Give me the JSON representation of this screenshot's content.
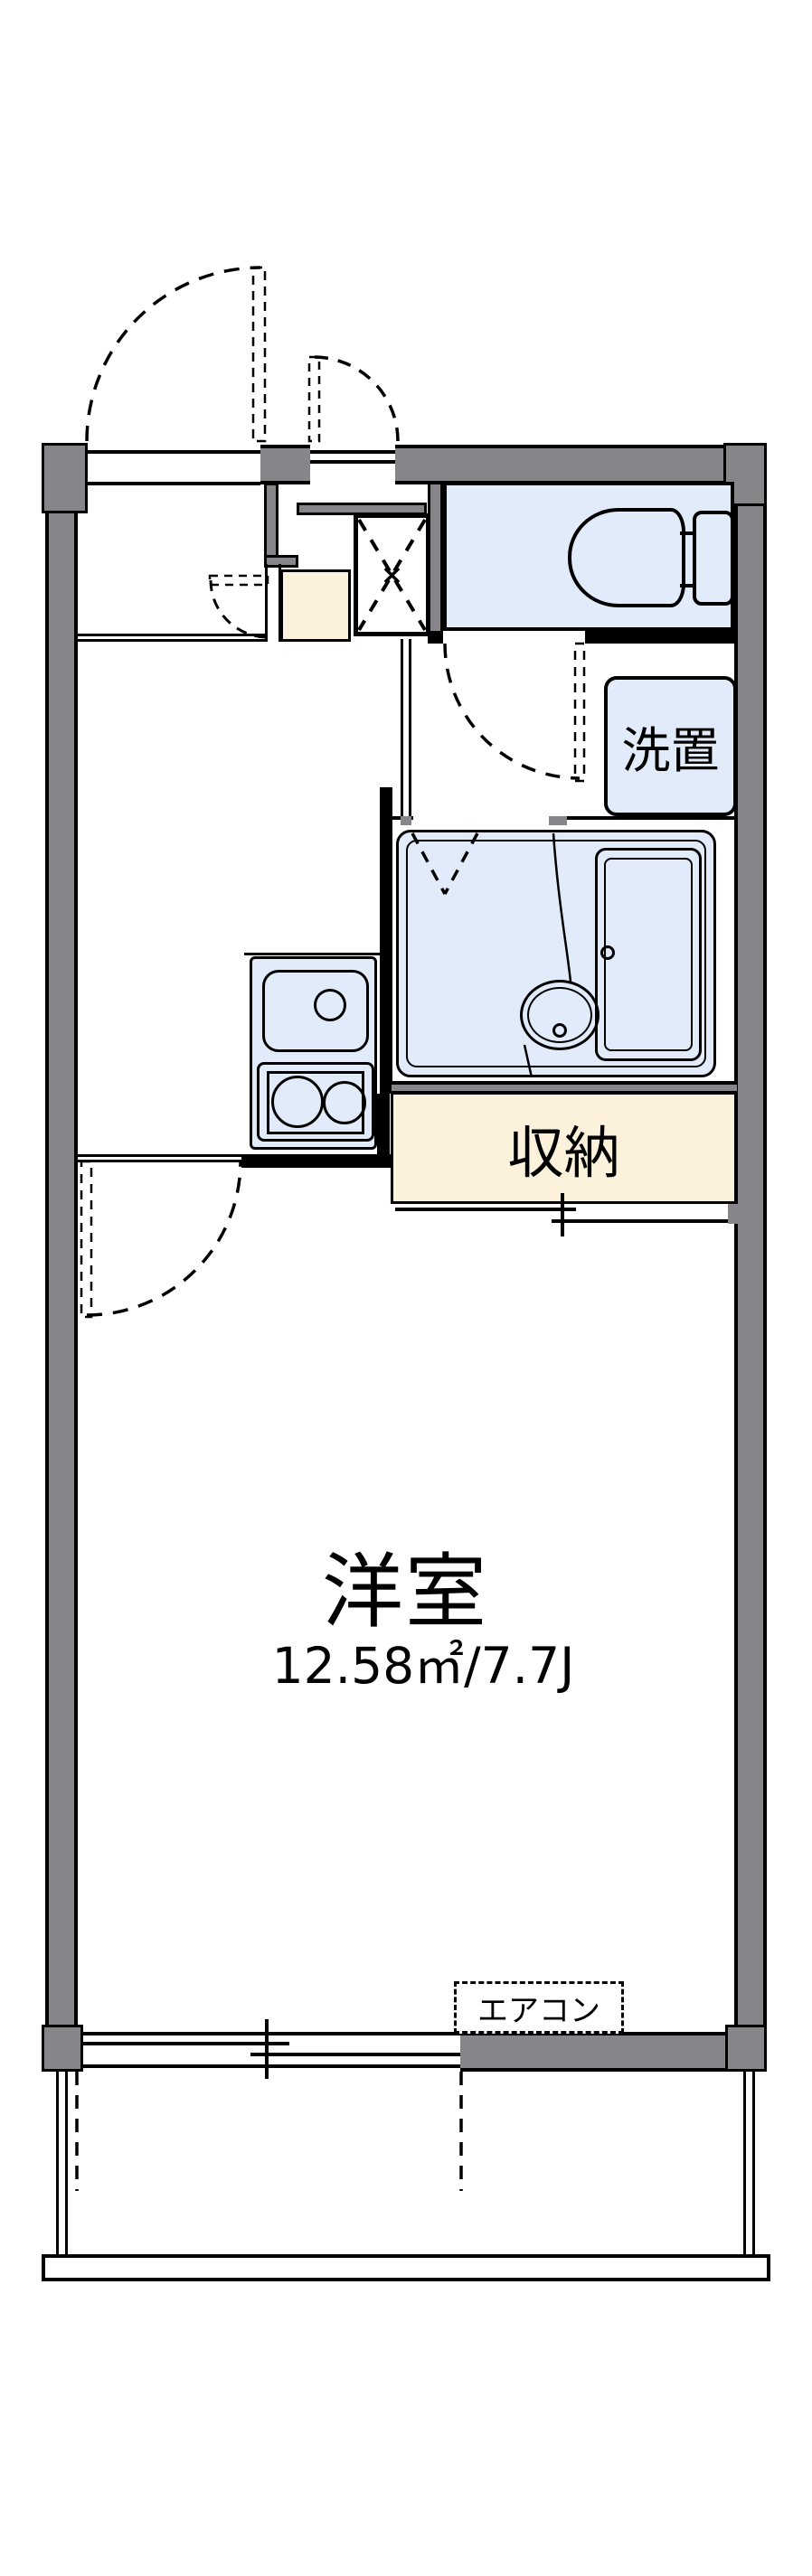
{
  "floorplan": {
    "type": "apartment-floor-plan",
    "labels": {
      "main_room_name": "洋室",
      "main_room_size": "12.58㎡/7.7J",
      "closet": "収納",
      "washer_space": "洗置",
      "air_conditioner": "エアコン",
      "meter_box_mark": "×"
    },
    "rooms": [
      {
        "name": "洋室",
        "size": "12.58㎡/7.7J"
      },
      {
        "name": "収納"
      },
      {
        "name": "洗置"
      },
      {
        "name": "toilet"
      },
      {
        "name": "unit-bath"
      },
      {
        "name": "kitchen"
      },
      {
        "name": "entrance-hall"
      },
      {
        "name": "balcony"
      }
    ],
    "colors": {
      "wall_gray": "#85858a",
      "fixture_blue": "#e2ebfa",
      "floor_beige": "#fcf2dc",
      "line_black": "#000000",
      "background_white": "#ffffff"
    }
  }
}
